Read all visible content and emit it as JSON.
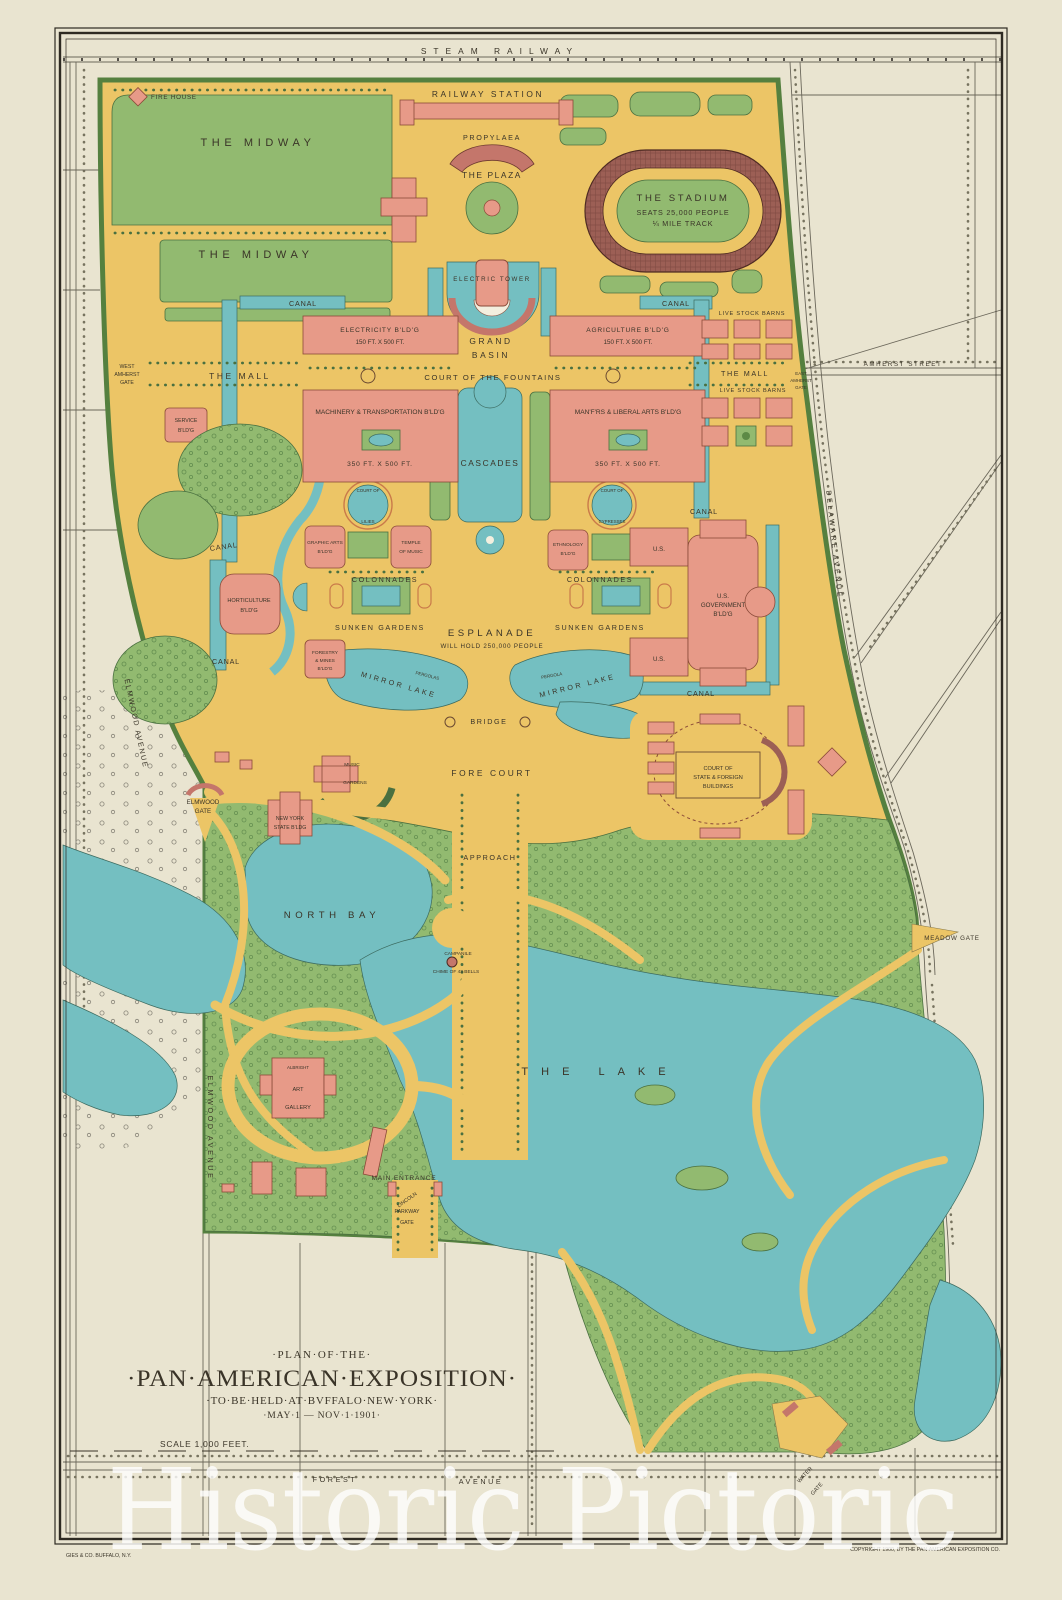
{
  "labels": {
    "steam_railway": "STEAM RAILWAY",
    "fire_house": "FIRE HOUSE",
    "the_midway": "THE MIDWAY",
    "railway_station": "RAILWAY STATION",
    "propylaea": "PROPYLAEA",
    "the_plaza": "THE PLAZA",
    "stadium": {
      "l1": "THE STADIUM",
      "l2": "SEATS 25,000 PEOPLE",
      "l3": "¼ MILE TRACK"
    },
    "electric_tower": "ELECTRIC  TOWER",
    "grand_basin": {
      "l1": "GRAND",
      "l2": "BASIN"
    },
    "canal": "CANAL",
    "electricity_bldg": {
      "l1": "ELECTRICITY B'LD'G",
      "l2": "150 FT. X 500 FT."
    },
    "agriculture_bldg": {
      "l1": "AGRICULTURE B'LD'G",
      "l2": "150 FT. X 500 FT."
    },
    "court_of_the_fountains": "COURT OF THE FOUNTAINS",
    "machinery_bldg": {
      "l1": "MACHINERY & TRANSPORTATION B'LD'G",
      "l2": "350 FT. X 500 FT."
    },
    "manfrs_bldg": {
      "l1": "MAN'F'RS & LIBERAL ARTS B'LD'G",
      "l2": "350 FT. X 500 FT."
    },
    "cascades": "CASCADES",
    "the_mall": "THE MALL",
    "west_amherst_gate": {
      "l1": "WEST",
      "l2": "AMHERST",
      "l3": "GATE"
    },
    "east_amherst_gate": {
      "l1": "EAST",
      "l2": "AMHERST",
      "l3": "GATE"
    },
    "amherst_street": "AMHERST STREET",
    "service_bldg": {
      "l1": "SERVICE",
      "l2": "B'LD'G"
    },
    "live_stock_barns": "LIVE STOCK BARNS",
    "court_of_lilies": {
      "l1": "COURT OF",
      "l2": "LILIES"
    },
    "court_of_cypresses": {
      "l1": "COURT OF",
      "l2": "CYPRESSES"
    },
    "graphic_arts": {
      "l1": "GRAPHIC ARTS",
      "l2": "B'LD'G"
    },
    "temple_of_music": {
      "l1": "TEMPLE",
      "l2": "OF MUSIC"
    },
    "ethnology": {
      "l1": "ETHNOLOGY",
      "l2": "B'LD'G"
    },
    "us": "U.S.",
    "colonnades": "COLONNADES",
    "horticulture": {
      "l1": "HORTICULTURE",
      "l2": "B'LD'G"
    },
    "sunken_gardens": "SUNKEN GARDENS",
    "esplanade": {
      "l1": "ESPLANADE",
      "l2": "WILL HOLD 250,000 PEOPLE"
    },
    "us_government": {
      "l1": "U.S.",
      "l2": "GOVERNMENT",
      "l3": "B'LD'G"
    },
    "forestry_mines": {
      "l1": "FORESTRY",
      "l2": "& MINES",
      "l3": "B'LD'G"
    },
    "mirror_lake": "MIRROR LAKE",
    "pergolas": "PERGOLAS",
    "pergola": "PERGOLA",
    "bridge": "BRIDGE",
    "fore_court": "FORE COURT",
    "approach": "APPROACH",
    "music_gardens": {
      "l1": "MUSIC",
      "l2": "GARDENS"
    },
    "court_state_foreign": {
      "l1": "COURT OF",
      "l2": "STATE & FOREIGN",
      "l3": "BUILDINGS"
    },
    "delaware_avenue": "DELAWARE AVENUE",
    "elmwood_avenue": "ELMWOOD AVENUE",
    "elmwood_gate": {
      "l1": "ELMWOOD",
      "l2": "GATE"
    },
    "new_york_state": {
      "l1": "NEW YORK",
      "l2": "STATE B'LDG"
    },
    "north_bay": "NORTH BAY",
    "meadow_gate": "MEADOW GATE",
    "campanile": {
      "l1": "CAMPANILE",
      "l2": "CHIME OF 43 BELLS"
    },
    "the_lake": "THE LAKE",
    "albright": "ALBRIGHT",
    "art_gallery": {
      "l1": "ART",
      "l2": "GALLERY"
    },
    "main_entrance": "MAIN ENTRANCE",
    "lincoln_gate": {
      "l1": "LINCOLN",
      "l2": "PARKWAY",
      "l3": "GATE"
    },
    "forest": "FOREST",
    "avenue": "AVENUE",
    "water_gate": {
      "l1": "WATER",
      "l2": "GATE"
    }
  },
  "title_block": {
    "line1": "·PLAN·OF·THE·",
    "line2": "·PAN·AMERICAN·EXPOSITION·",
    "line3": "·TO·BE·HELD·AT·BVFFALO·NEW·YORK·",
    "line4": "·MAY·1 — NOV·1·1901·",
    "scale": "SCALE   1,000   FEET."
  },
  "credits": {
    "printer": "GIES & CO. BUFFALO, N.Y.",
    "copyright": "COPYRIGHT 1900, BY THE PAN-AMERICAN EXPOSITION CO."
  },
  "watermark": "Historic Pictoric",
  "colors": {
    "paper": "#e9e4d0",
    "grounds": "#ecc566",
    "park": "#92ba70",
    "water": "#74bfc1",
    "building": "#e79a88",
    "track": "#9c5f55",
    "ink": "#3a3428"
  }
}
